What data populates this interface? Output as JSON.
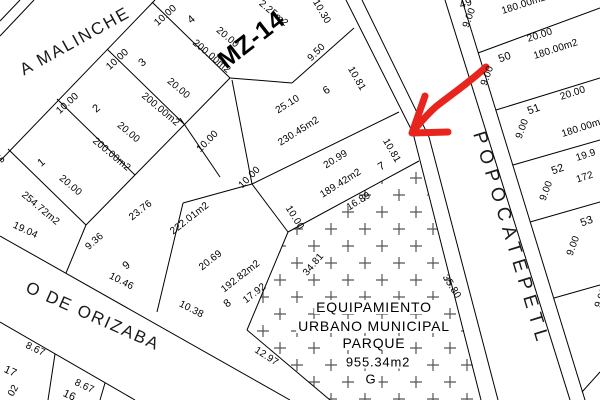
{
  "map": {
    "block_label": "MZ-14",
    "streets": {
      "malinche": "A MALINCHE",
      "orizaba": "O DE ORIZABA",
      "popocatepetl": "POPOCATEPETL"
    },
    "park": {
      "line1": "EQUIPAMIENTO",
      "line2": "URBANO MUNICIPAL",
      "line3": "PARQUE",
      "area": "955.34m2",
      "tag": "G"
    },
    "labels": {
      "lot1_num": "1",
      "lot1_front": "5",
      "lot1_len": "20.00",
      "lot1_area": "254.72m2",
      "lot1_south": "19.04",
      "lot2_num": "2",
      "lot2_front": "10.00",
      "lot2_len": "20.00",
      "lot2_area": "200.00m2",
      "lot3_num": "3",
      "lot3_front": "10.00",
      "lot3_len": "20.00",
      "lot3_area": "200.00m2",
      "lot4_num": "4",
      "lot4_front": "10.00",
      "lot4_len": "20.00",
      "lot4_area": "200.00m2",
      "lot5_area": "2.25m2",
      "lot5_front": "10.30",
      "lot5_edge": "9.50",
      "lot6_num": "6",
      "lot6_len": "25.10",
      "lot6_area": "230.45m2",
      "lot6_back": "10.00",
      "lot6_front": "10.81",
      "lot7_num": "7",
      "lot7_len": "20.99",
      "lot7_area": "189.42m2",
      "lot7_back": "10.00",
      "lot7_side": "10.00",
      "lot7_south": "16.89",
      "lot7_front": "10.81",
      "lot8_num": "8",
      "lot8_len": "20.69",
      "lot8_area": "192.82m2",
      "lot8_east": "17.92",
      "lot8_front": "10.38",
      "lot8_south": "12.97",
      "lot9_num": "9",
      "lot9_len": "23.76",
      "lot9_area": "222.01m2",
      "lot9_west": "9.36",
      "lot9_front": "10.46",
      "lot16_num": "16",
      "lot16_front": "8.67",
      "lot17_num": "17",
      "lot17_front": "8.67",
      "lot17_partial": "02",
      "lot49_num": "49",
      "lot49_area": "180.00m2",
      "lot49_front": "9.00",
      "lot50_num": "50",
      "lot50_len": "20.00",
      "lot50_area": "180.00m2",
      "lot50_front": "9.00",
      "lot51_num": "51",
      "lot51_len": "20.00",
      "lot51_area": "180.00m2",
      "lot51_front": "9.00",
      "lot52_num": "52",
      "lot52_len": "19.9",
      "lot52_area": "172",
      "lot52_front": "9.00",
      "lot53_num": "53",
      "lot53_front": "9.00",
      "lot53_side": "9.00",
      "park_west": "34.81",
      "park_front": "35.80"
    }
  },
  "arrow": {
    "color": "#e8251d"
  }
}
